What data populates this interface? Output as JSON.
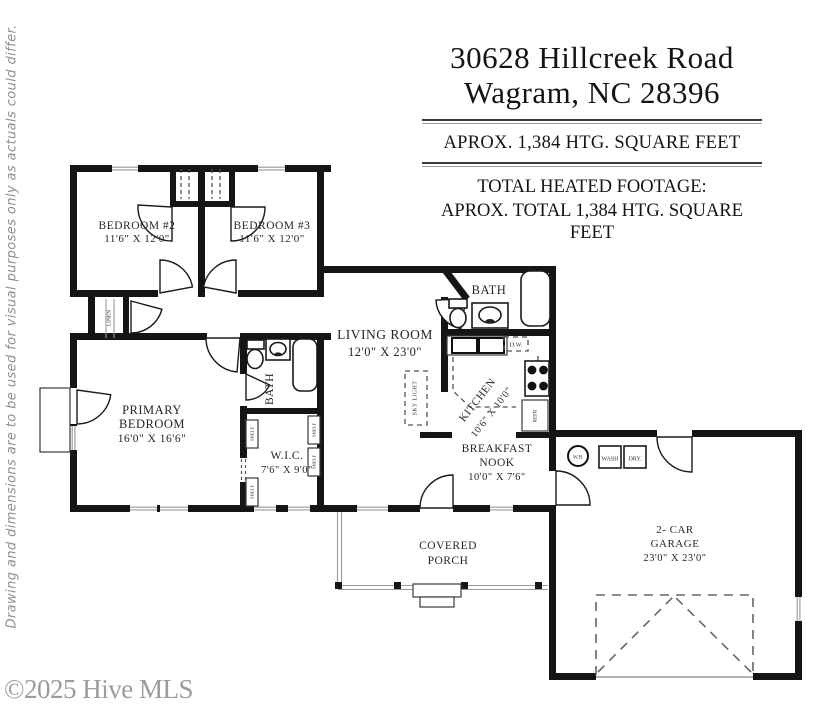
{
  "page": {
    "disclaimer": "Drawing and dimensions are to be used for visual purposes only as actuals could differ.",
    "copyright": "©2025 Hive MLS"
  },
  "header": {
    "address_line1": "30628 Hillcreek Road",
    "address_line2": "Wagram, NC 28396",
    "sqft_line": "APROX. 1,384 HTG. SQUARE FEET",
    "total_heading": "TOTAL HEATED FOOTAGE:",
    "total_line": "APROX. TOTAL 1,384 HTG. SQUARE FEET"
  },
  "plan": {
    "rooms": {
      "bedroom2": {
        "name": "BEDROOM #2",
        "dims": "11'6\" X 12'0\""
      },
      "bedroom3": {
        "name": "BEDROOM #3",
        "dims": "11'6\" X 12'0\""
      },
      "living_room": {
        "name": "LIVING ROOM",
        "dims": "12'0\" X 23'0\""
      },
      "primary_bedroom": {
        "line1": "PRIMARY",
        "line2": "BEDROOM",
        "dims": "16'0\" X 16'6\""
      },
      "wic": {
        "name": "W.I.C.",
        "dims": "7'6\" X 9'0\""
      },
      "kitchen": {
        "name": "KITCHEN",
        "dims": "10'6\" X 10'0\""
      },
      "breakfast_nook": {
        "line1": "BREAKFAST",
        "line2": "NOOK",
        "dims": "10'0\" X 7'6\""
      },
      "covered_porch": {
        "line1": "COVERED",
        "line2": "PORCH"
      },
      "garage": {
        "line1": "2- CAR",
        "line2": "GARAGE",
        "dims": "23'0\" X 23'0\""
      },
      "bath": {
        "name": "BATH"
      }
    },
    "labels": {
      "linen": "LINEN",
      "shelf": "SHELF",
      "sky_light": "SKY LIGHT",
      "dishwasher": "D.W.",
      "refrigerator": "REFR",
      "water_heater": "W.H.",
      "washer": "WASH",
      "dryer": "DRY."
    },
    "colors": {
      "wall": "#151515",
      "label": "#262626",
      "muted": "#8f8f8f"
    }
  }
}
